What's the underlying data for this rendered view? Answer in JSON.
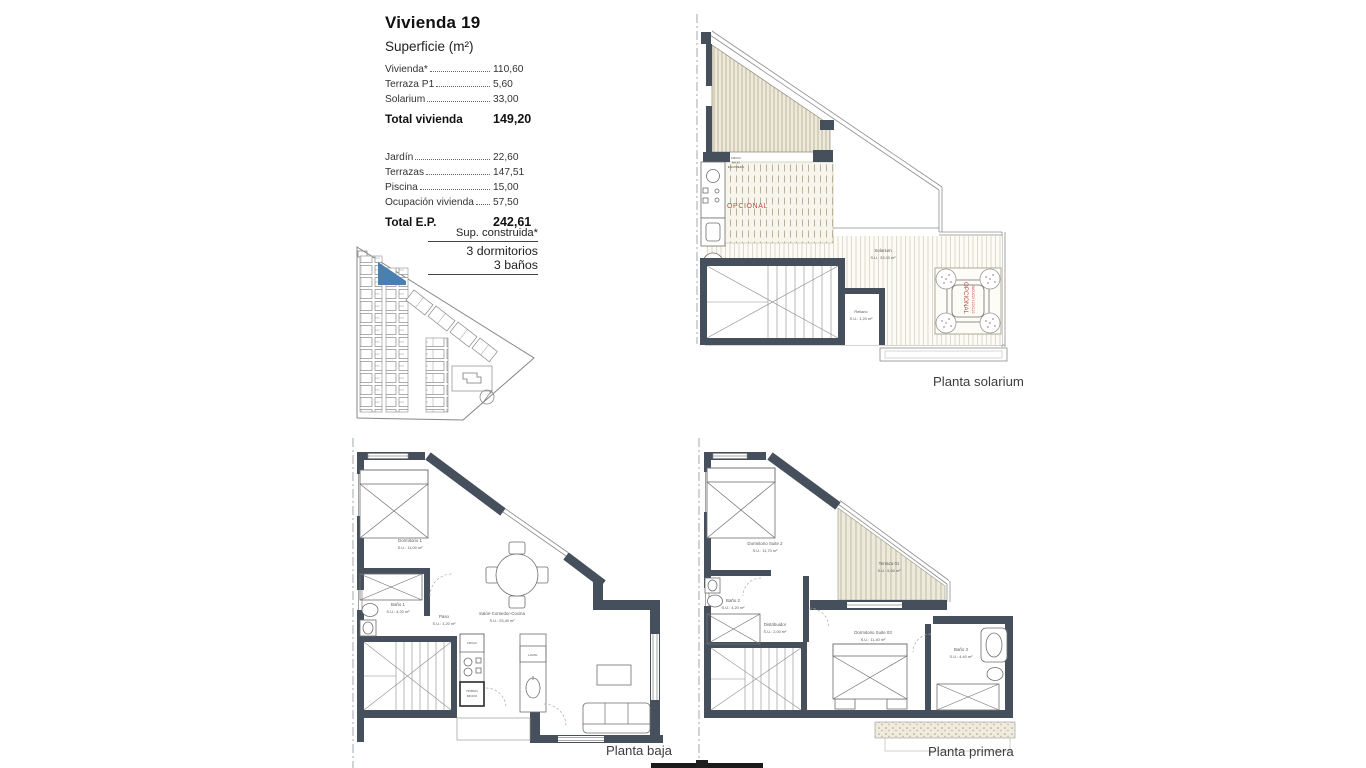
{
  "title_block": {
    "title": "Vivienda 19",
    "subtitle": "Superficie (m²)",
    "groups": [
      {
        "rows": [
          {
            "label": "Vivienda*",
            "value": "110,60"
          },
          {
            "label": "Terraza P1",
            "value": "5,60"
          },
          {
            "label": "Solarium",
            "value": "33,00"
          }
        ],
        "total": {
          "label": "Total vivienda",
          "value": "149,20"
        }
      },
      {
        "rows": [
          {
            "label": "Jardín",
            "value": "22,60"
          },
          {
            "label": "Terrazas",
            "value": "147,51"
          },
          {
            "label": "Piscina",
            "value": "15,00"
          },
          {
            "label": "Ocupación vivienda",
            "value": "57,50"
          }
        ],
        "total": {
          "label": "Total E.P.",
          "value": "242,61"
        }
      }
    ]
  },
  "construida_block": {
    "line1": "Sup. construida*",
    "line2": "3 dormitorios",
    "line3": "3 baños"
  },
  "solarium_plan": {
    "caption": "Planta solarium",
    "room_solarium": "Solarium",
    "room_solarium_area": "S.U.: 33,00 m²",
    "room_rellano": "Rellano",
    "room_rellano_area": "S.U.: 1,20 m²",
    "optional_label": "OPCIONAL",
    "jacuzzi_optional": "OPCIONAL",
    "jacuzzi_label": "JACUZZI 122X122",
    "acs_label": "ACS",
    "kitchen_note_1": "FRIGO",
    "kitchen_note_2": "BAJO",
    "kitchen_note_3": "ENCIMERA"
  },
  "baja_plan": {
    "caption": "Planta baja",
    "dorm1": "Dormitorio 1",
    "dorm1_area": "S.U.: 11,00 m²",
    "bano1": "Baño 1",
    "bano1_area": "S.U.: 4,20 m²",
    "paso": "Paso",
    "paso_area": "S.U.: 1,20 m²",
    "salon": "Salón-Comedor-Cocina",
    "salon_area": "S.U.: 25,40 m²",
    "frigo": "FRIGO",
    "horno_1": "HORNO",
    "horno_2": "MICRO",
    "lavav": "LAVAV."
  },
  "primera_plan": {
    "caption": "Planta primera",
    "suite2": "Dormitorio Suite 2",
    "suite2_area": "S.U.: 11,70 m²",
    "terraza": "Terraza 01",
    "terraza_area": "S.U.: 5,60 m²",
    "bano2": "Baño 2",
    "bano2_area": "S.U.: 4,20 m²",
    "distribuidor": "Distribuidor",
    "distribuidor_area": "S.U.: 2,00 m²",
    "suite03": "Dormitorio Suite 03",
    "suite03_area": "S.U.: 11,40 m²",
    "bano3": "Baño 3",
    "bano3_area": "S.U.: 4,40 m²"
  },
  "colors": {
    "wall": "#46505c",
    "optional_red": "#bf4a44",
    "highlight_blue": "#4a80b0",
    "stripe_beige": "#edead9",
    "line_gray": "#8d8d8d"
  }
}
